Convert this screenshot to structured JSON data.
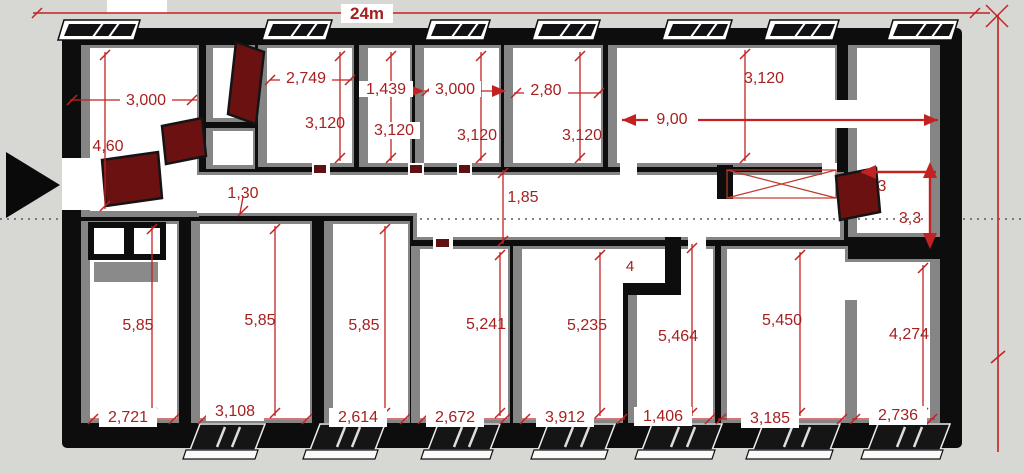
{
  "drawing": {
    "type": "floor-plan-sketch",
    "overall": {
      "width_label": "24m"
    }
  },
  "colors": {
    "background": "#d7d7d3",
    "wall_black": "#0d0d0d",
    "wall_face_gray": "#858585",
    "floor_white": "#ffffff",
    "dimension_red": "#c22222",
    "label_red": "#a62020",
    "door_dark_red": "#6b1111"
  },
  "corridor": {
    "left_width": "1,30",
    "main_width": "1,85"
  },
  "top_rooms": [
    {
      "width": "3,000",
      "depth": "4,60"
    },
    {
      "width": "2,749",
      "depth": "3,120"
    },
    {
      "width": "1,439",
      "depth": "3,120"
    },
    {
      "width": "3,000",
      "depth": "3,120"
    },
    {
      "width": "2,80",
      "depth": "3,120"
    },
    {
      "width": "9,00",
      "depth": "3,120"
    },
    {
      "width": "3",
      "depth": "3,3"
    }
  ],
  "bottom_rooms": [
    {
      "width": "2,721",
      "depth": "5,85"
    },
    {
      "width": "3,108",
      "depth": "5,85"
    },
    {
      "width": "2,614",
      "depth": "5,85"
    },
    {
      "width": "2,672",
      "depth": "5,241"
    },
    {
      "width": "3,912",
      "depth": "5,235",
      "nook_label": "4"
    },
    {
      "width": "1,406",
      "depth": "5,464"
    },
    {
      "width": "3,185",
      "depth": "5,450"
    },
    {
      "width": "2,736",
      "depth": "4,274"
    }
  ]
}
